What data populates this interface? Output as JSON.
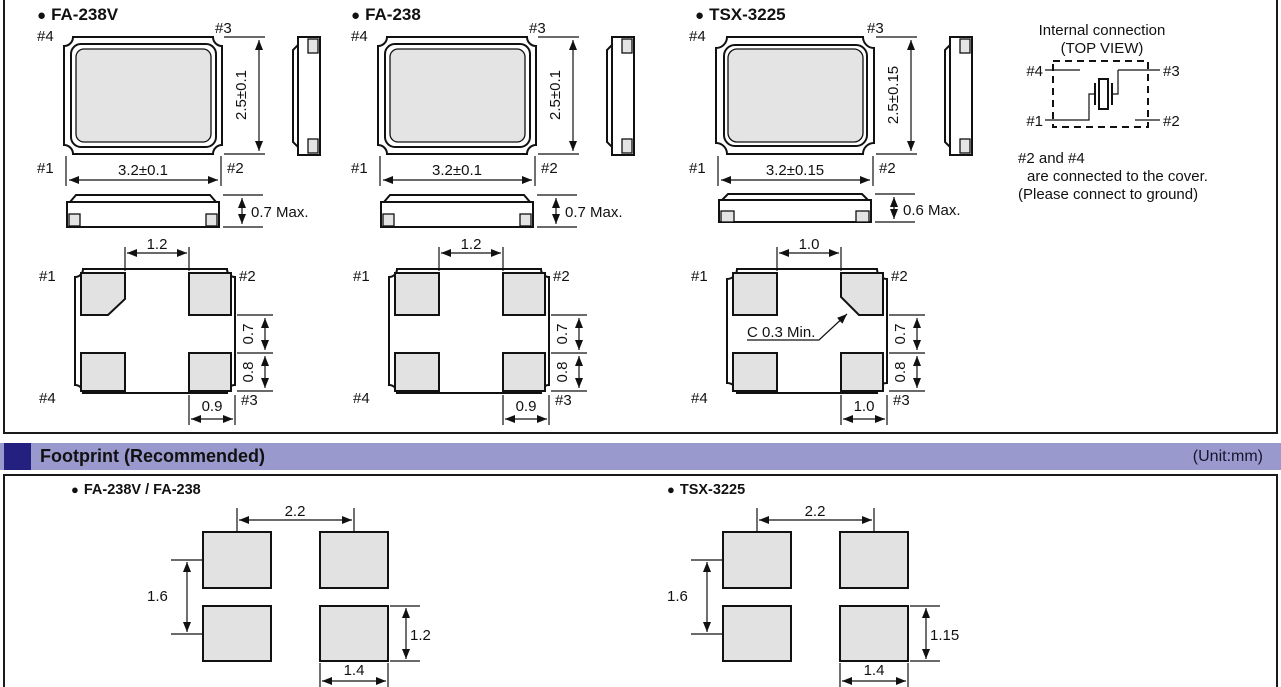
{
  "glyphs": {
    "bullet": "●"
  },
  "colors": {
    "header_bg": "#9a99cd",
    "header_square": "#23207f",
    "line": "#111111",
    "body_fill": "#e4e4e4",
    "pad_fill": "#e2e2e2"
  },
  "packages": [
    {
      "name": "FA-238V",
      "top_view": {
        "pin_tl": "#4",
        "pin_tr": "#3",
        "pin_bl": "#1",
        "pin_br": "#2",
        "width": "3.2±0.1",
        "height": "2.5±0.1"
      },
      "profile": {
        "height": "0.7 Max."
      },
      "pad_view": {
        "pin_tl": "#1",
        "pin_tr": "#2",
        "pin_bl": "#4",
        "pin_br": "#3",
        "top": "1.2",
        "right_upper": "0.7",
        "right_lower": "0.8",
        "bottom": "0.9"
      }
    },
    {
      "name": "FA-238",
      "top_view": {
        "pin_tl": "#4",
        "pin_tr": "#3",
        "pin_bl": "#1",
        "pin_br": "#2",
        "width": "3.2±0.1",
        "height": "2.5±0.1"
      },
      "profile": {
        "height": "0.7 Max."
      },
      "pad_view": {
        "pin_tl": "#1",
        "pin_tr": "#2",
        "pin_bl": "#4",
        "pin_br": "#3",
        "top": "1.2",
        "right_upper": "0.7",
        "right_lower": "0.8",
        "bottom": "0.9"
      }
    },
    {
      "name": "TSX-3225",
      "top_view": {
        "pin_tl": "#4",
        "pin_tr": "#3",
        "pin_bl": "#1",
        "pin_br": "#2",
        "width": "3.2±0.15",
        "height": "2.5±0.15"
      },
      "profile": {
        "height": "0.6 Max."
      },
      "pad_view": {
        "pin_tl": "#1",
        "pin_tr": "#2",
        "pin_bl": "#4",
        "pin_br": "#3",
        "top": "1.0",
        "right_upper": "0.7",
        "right_lower": "0.8",
        "bottom": "1.0",
        "chamfer_note": "C 0.3 Min."
      }
    }
  ],
  "internal_connection": {
    "title_line1": "Internal connection",
    "title_line2": "(TOP VIEW)",
    "pin_tl": "#4",
    "pin_tr": "#3",
    "pin_bl": "#1",
    "pin_br": "#2",
    "note_line1": "#2 and #4",
    "note_line2": "are connected to the cover.",
    "note_line3": "(Please connect to ground)"
  },
  "footprint_section": {
    "title": "Footprint (Recommended)",
    "unit": "(Unit:mm)",
    "footprints": [
      {
        "name": "FA-238V / FA-238",
        "pitch_x": "2.2",
        "pitch_y": "1.6",
        "pad_height": "1.2",
        "pad_width": "1.4"
      },
      {
        "name": "TSX-3225",
        "pitch_x": "2.2",
        "pitch_y": "1.6",
        "pad_height": "1.15",
        "pad_width": "1.4"
      }
    ]
  }
}
